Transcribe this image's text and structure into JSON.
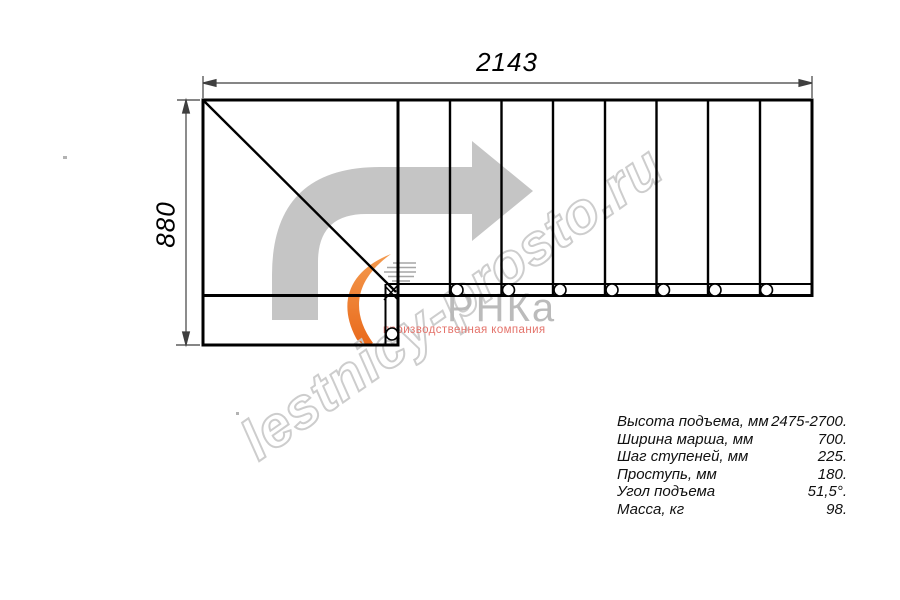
{
  "dimensions": {
    "width_mm": "2143",
    "height_mm": "880"
  },
  "specs": {
    "rows": [
      {
        "label": "Высота подъема, мм",
        "value": "2475-2700."
      },
      {
        "label": "Ширина марша, мм",
        "value": "700."
      },
      {
        "label": "Шаг ступеней, мм",
        "value": "225."
      },
      {
        "label": "Проступь, мм",
        "value": "180."
      },
      {
        "label": "Угол подъема",
        "value": "51,5°."
      },
      {
        "label": "Масса, кг",
        "value": "98."
      }
    ]
  },
  "watermark": {
    "site": "lestnicy-prosto.ru",
    "logo_text": "РНКа",
    "logo_subtitle": "производственная компания"
  },
  "colors": {
    "drawing_line": "#000000",
    "dimension_line": "#3f3f3f",
    "arrow_gray": "#c5c5c5",
    "watermark_gray": "#cbcbcb",
    "logo_gray": "#b6b6b6",
    "logo_orange": "#ee7b28",
    "subtitle_red": "#e4736b"
  },
  "icons": {
    "direction_arrow": "turn-right-arrow",
    "logo_swoosh": "orange-crescent"
  }
}
